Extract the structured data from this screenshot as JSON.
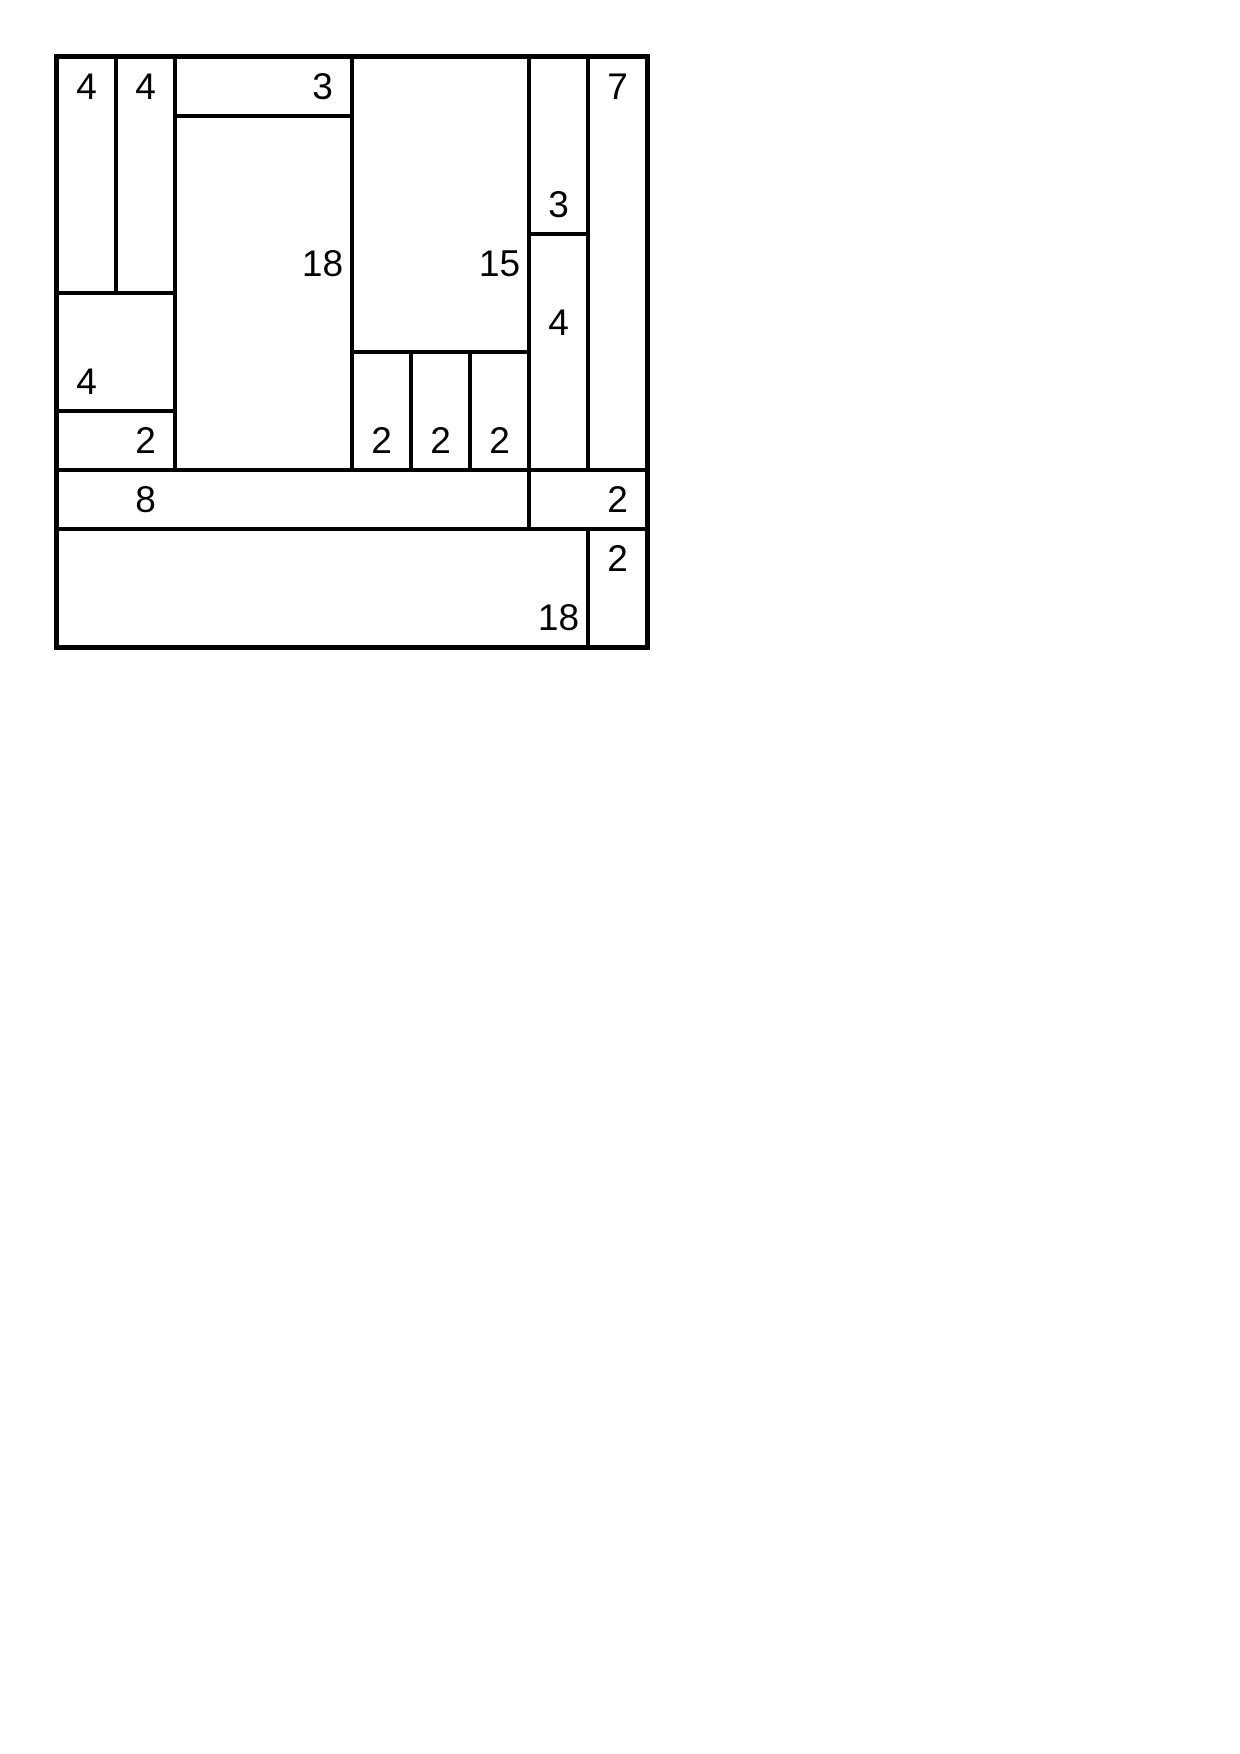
{
  "page": {
    "background_color": "#ffffff"
  },
  "diagram": {
    "type": "rectangle-dissection-puzzle",
    "description": "10x10 square partitioned into rectangles; each printed number equals the area of its rectangle",
    "grid": {
      "cols": 10,
      "rows": 10,
      "unit_px": 59,
      "origin_x_px": 57,
      "origin_y_px": 57
    },
    "style": {
      "line_color": "#000000",
      "background_color": "#ffffff",
      "outer_border_px": 5,
      "inner_line_px": 4,
      "label_font_px": 37
    },
    "rectangles": [
      {
        "label": "4",
        "x": 0,
        "y": 0,
        "w": 1,
        "h": 4,
        "label_cell": {
          "x": 0,
          "y": 0
        }
      },
      {
        "label": "4",
        "x": 1,
        "y": 0,
        "w": 1,
        "h": 4,
        "label_cell": {
          "x": 1,
          "y": 0
        }
      },
      {
        "label": "3",
        "x": 2,
        "y": 0,
        "w": 3,
        "h": 1,
        "label_cell": {
          "x": 4,
          "y": 0
        }
      },
      {
        "label": "18",
        "x": 2,
        "y": 1,
        "w": 3,
        "h": 6,
        "label_cell": {
          "x": 4,
          "y": 3
        }
      },
      {
        "label": "15",
        "x": 5,
        "y": 0,
        "w": 3,
        "h": 5,
        "label_cell": {
          "x": 7,
          "y": 3
        }
      },
      {
        "label": "3",
        "x": 8,
        "y": 0,
        "w": 1,
        "h": 3,
        "label_cell": {
          "x": 8,
          "y": 2
        }
      },
      {
        "label": "7",
        "x": 9,
        "y": 0,
        "w": 1,
        "h": 7,
        "label_cell": {
          "x": 9,
          "y": 0
        }
      },
      {
        "label": "4",
        "x": 8,
        "y": 3,
        "w": 1,
        "h": 4,
        "label_cell": {
          "x": 8,
          "y": 4
        }
      },
      {
        "label": "4",
        "x": 0,
        "y": 4,
        "w": 2,
        "h": 2,
        "label_cell": {
          "x": 0,
          "y": 5
        }
      },
      {
        "label": "2",
        "x": 0,
        "y": 6,
        "w": 2,
        "h": 1,
        "label_cell": {
          "x": 1,
          "y": 6
        }
      },
      {
        "label": "2",
        "x": 5,
        "y": 5,
        "w": 1,
        "h": 2,
        "label_cell": {
          "x": 5,
          "y": 6
        }
      },
      {
        "label": "2",
        "x": 6,
        "y": 5,
        "w": 1,
        "h": 2,
        "label_cell": {
          "x": 6,
          "y": 6
        }
      },
      {
        "label": "2",
        "x": 7,
        "y": 5,
        "w": 1,
        "h": 2,
        "label_cell": {
          "x": 7,
          "y": 6
        }
      },
      {
        "label": "8",
        "x": 0,
        "y": 7,
        "w": 8,
        "h": 1,
        "label_cell": {
          "x": 1,
          "y": 7
        }
      },
      {
        "label": "2",
        "x": 8,
        "y": 7,
        "w": 2,
        "h": 1,
        "label_cell": {
          "x": 9,
          "y": 7
        }
      },
      {
        "label": "18",
        "x": 0,
        "y": 8,
        "w": 9,
        "h": 2,
        "label_cell": {
          "x": 8,
          "y": 9
        }
      },
      {
        "label": "2",
        "x": 9,
        "y": 8,
        "w": 1,
        "h": 2,
        "label_cell": {
          "x": 9,
          "y": 8
        }
      }
    ]
  }
}
